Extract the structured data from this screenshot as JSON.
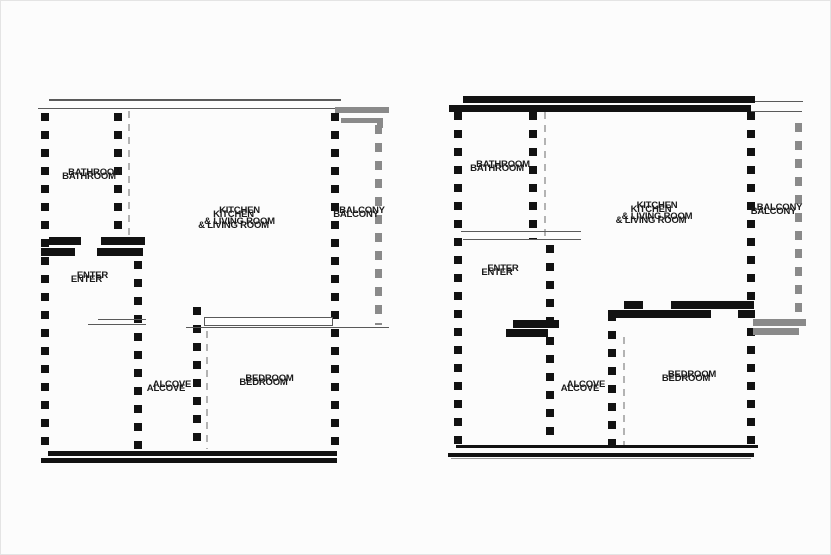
{
  "title": "apartment-floor-plans",
  "colors": {
    "wall_black": "#121212",
    "wall_gray": "#8a8a8a",
    "thin_line": "#5a5a5a",
    "dash_gray": "#b3b3b3",
    "label": "#1b1b1b",
    "background": "#fcfcfc"
  },
  "plans": [
    {
      "id": "left-floor-plan",
      "rooms": {
        "bathroom": "BATHROOM",
        "kitchen_living": "KITCHEN\n& LIVING ROOM",
        "balcony": "BALCONY",
        "enter": "ENTER",
        "alcove": "ALCOVE",
        "bedroom": "BEDROOM"
      }
    },
    {
      "id": "right-floor-plan",
      "rooms": {
        "bathroom": "BATHROOM",
        "kitchen_living": "KITCHEN\n& LIVING ROOM",
        "balcony": "BALCONY",
        "enter": "ENTER",
        "alcove": "ALCOVE",
        "bedroom": "BEDROOM"
      }
    }
  ]
}
